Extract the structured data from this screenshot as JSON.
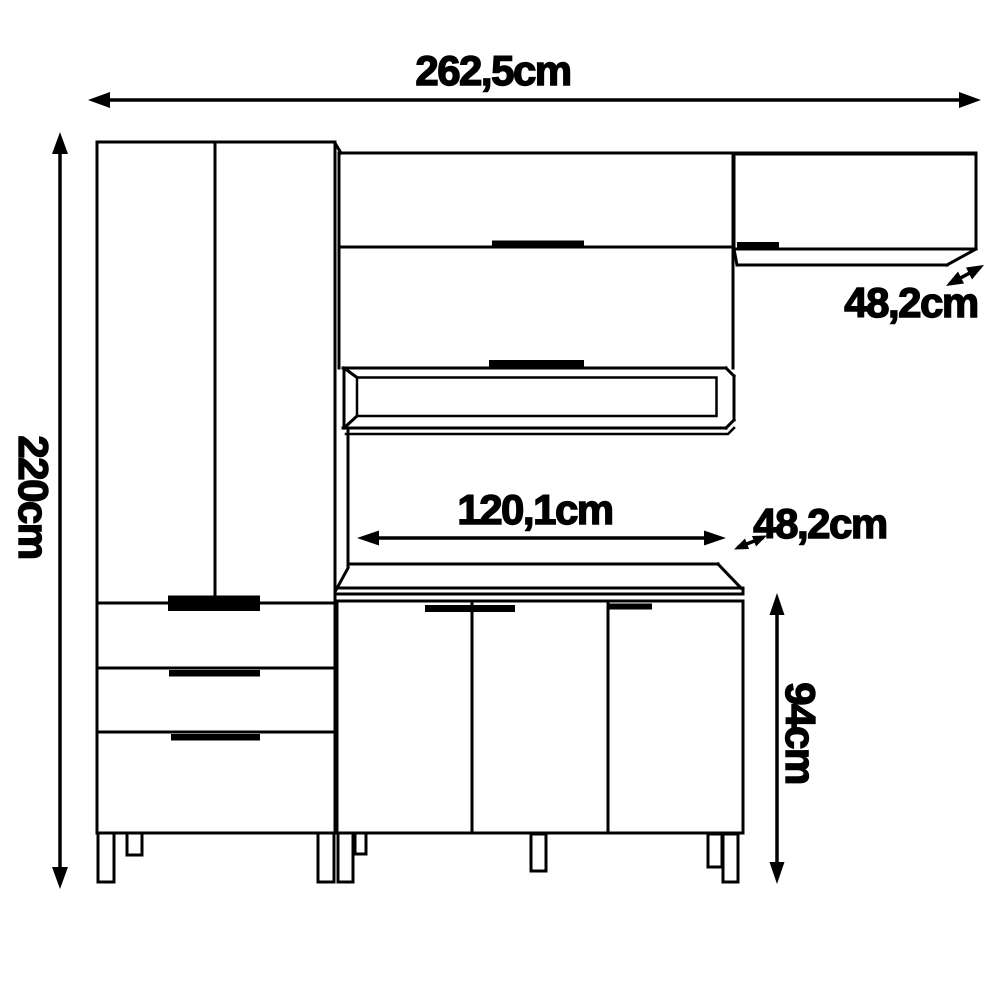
{
  "labels": {
    "total_width": "262,5cm",
    "total_height": "220cm",
    "corner_depth": "48,2cm",
    "counter_width": "120,1cm",
    "counter_depth": "48,2cm",
    "base_height": "94cm"
  },
  "colors": {
    "line": "#000000",
    "background": "#ffffff"
  }
}
